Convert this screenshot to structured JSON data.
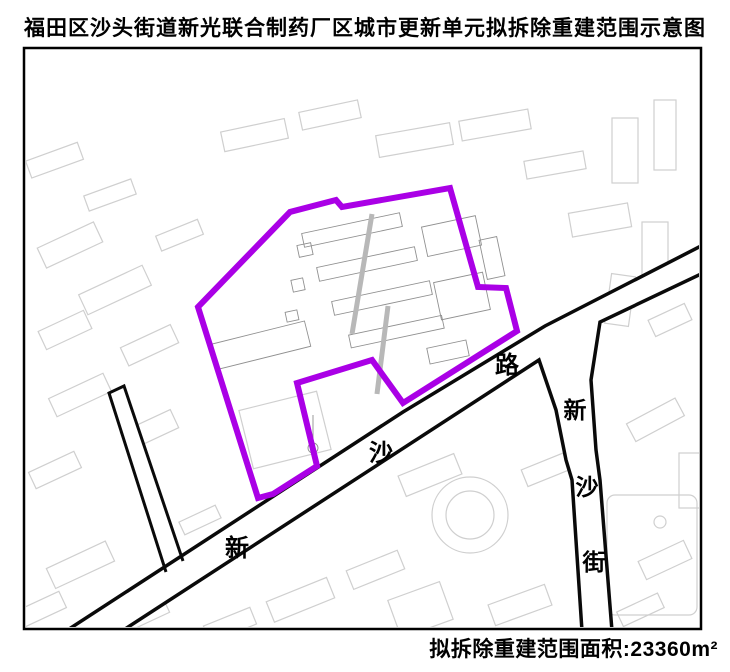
{
  "title": "福田区沙头街道新光联合制药厂区城市更新单元拟拆除重建范围示意图",
  "caption": {
    "label": "拟拆除重建范围面积",
    "separator": ":",
    "value": "23360",
    "unit": "m²"
  },
  "map": {
    "roads": [
      {
        "name": "新沙路",
        "chars": [
          "新",
          "沙",
          "路"
        ]
      },
      {
        "name": "新沙街",
        "chars": [
          "新",
          "沙",
          "街"
        ]
      }
    ]
  },
  "colors": {
    "boundary": "#AA00E6",
    "road_edge": "#0a0a0a",
    "building_light": "#cfcfcf",
    "building_inner": "#909090"
  }
}
